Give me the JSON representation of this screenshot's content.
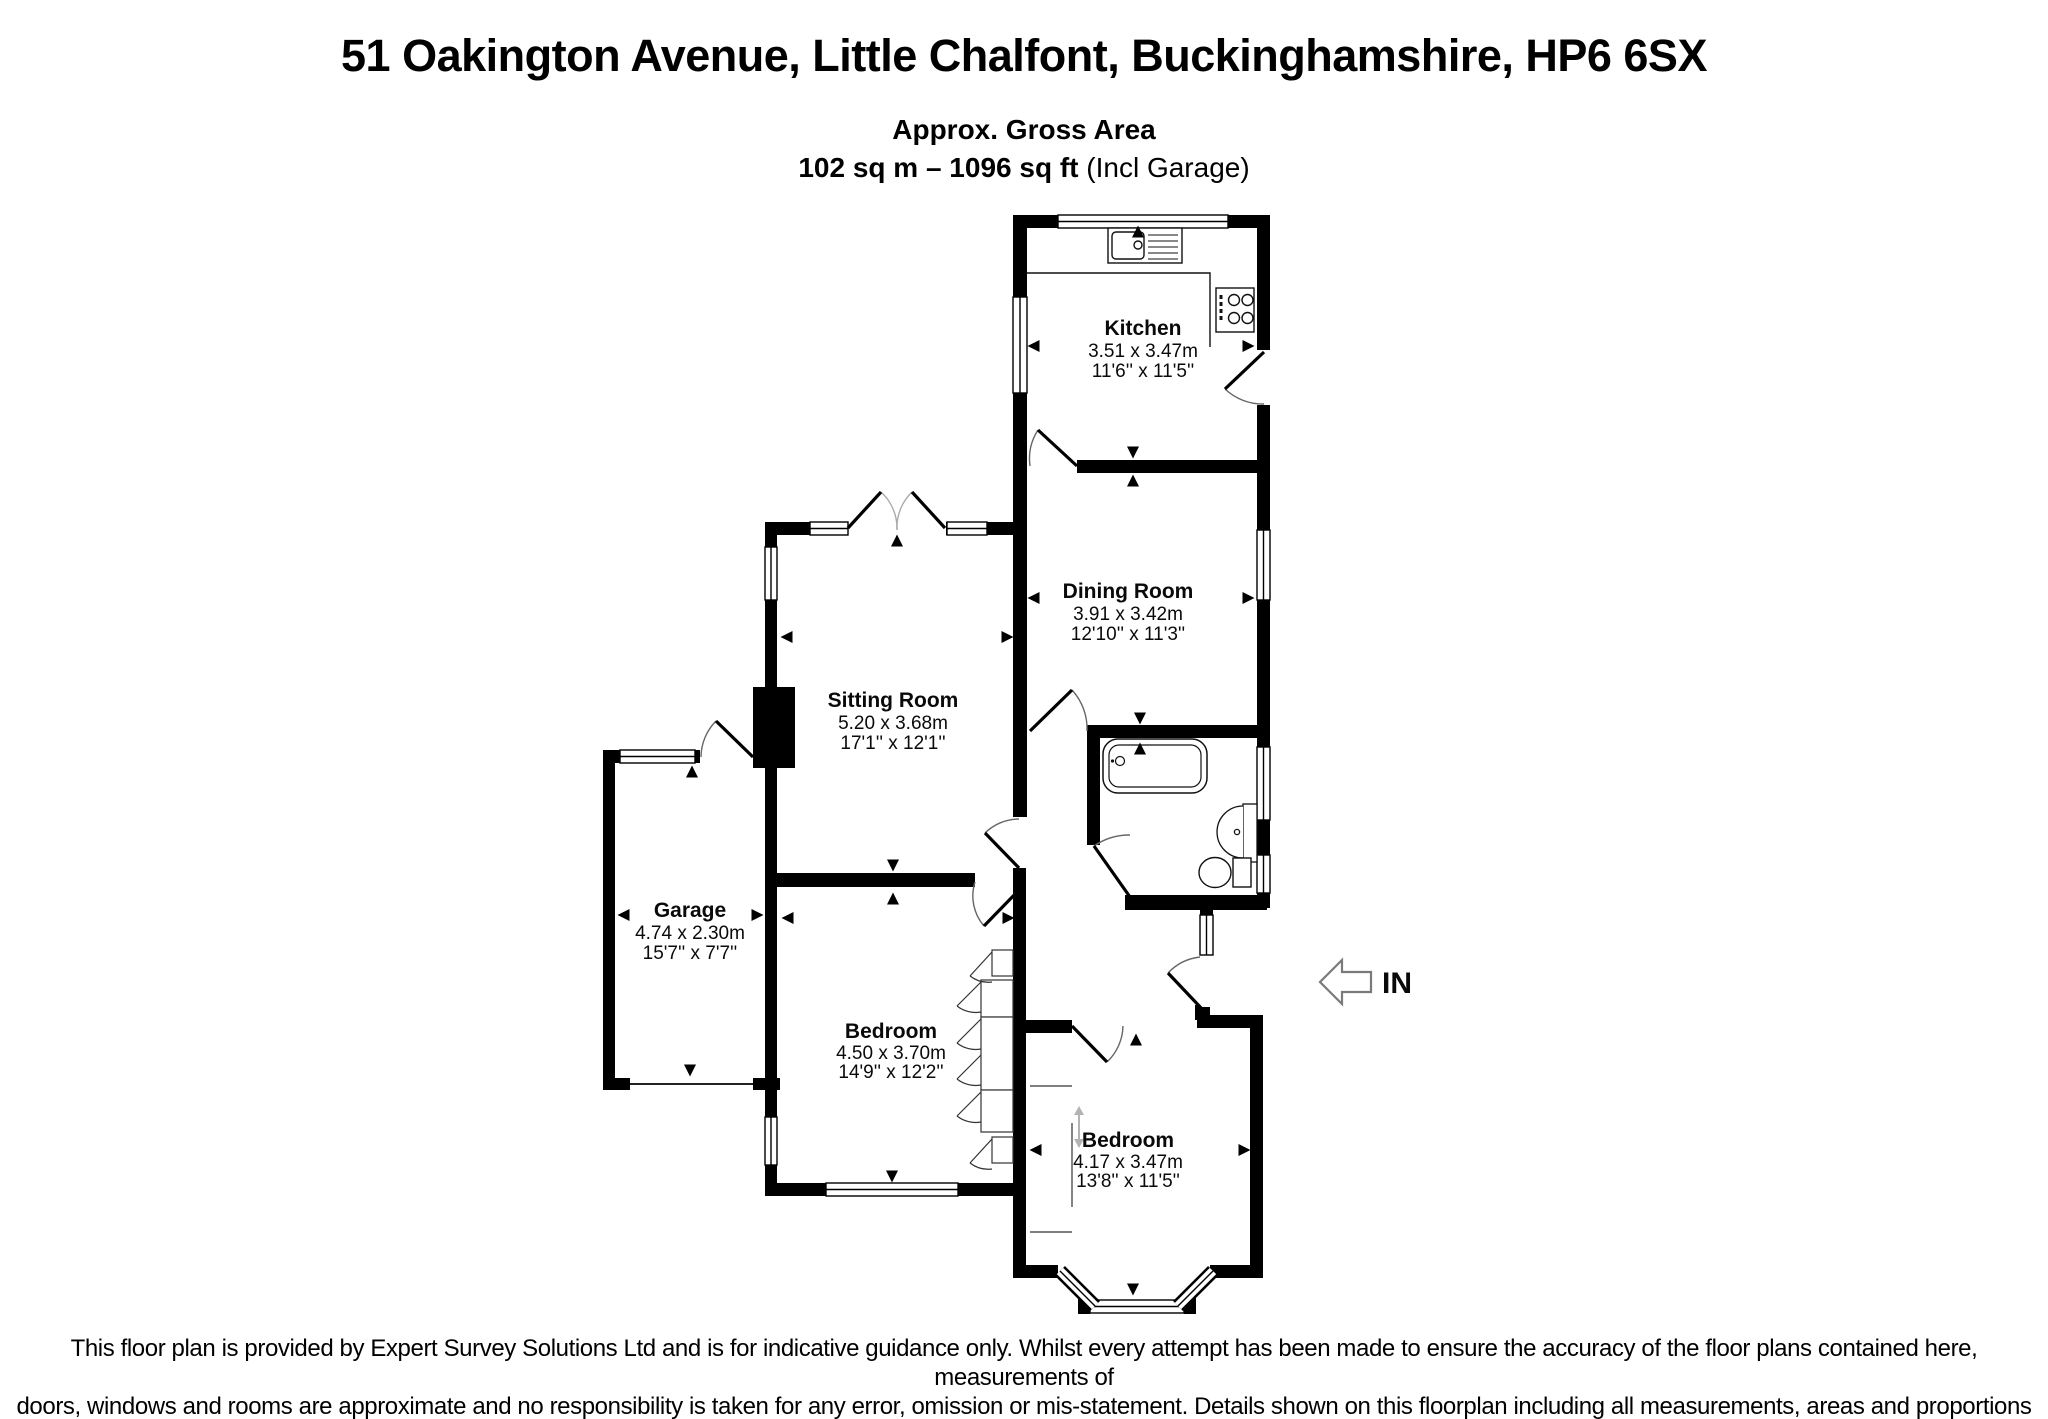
{
  "header": {
    "title": "51 Oakington Avenue, Little Chalfont, Buckinghamshire, HP6 6SX",
    "area_heading": "Approx. Gross Area",
    "area_value": "102 sq m – 1096 sq ft",
    "area_note": " (Incl Garage)"
  },
  "rooms": {
    "kitchen": {
      "name": "Kitchen",
      "metric": "3.51 x 3.47m",
      "imperial": "11'6'' x 11'5''"
    },
    "dining": {
      "name": "Dining Room",
      "metric": "3.91 x 3.42m",
      "imperial": "12'10'' x 11'3''"
    },
    "sitting": {
      "name": "Sitting Room",
      "metric": "5.20 x 3.68m",
      "imperial": "17'1'' x 12'1''"
    },
    "garage": {
      "name": "Garage",
      "metric": "4.74 x 2.30m",
      "imperial": "15'7'' x 7'7''"
    },
    "bedroom1": {
      "name": "Bedroom",
      "metric": "4.50 x 3.70m",
      "imperial": "14'9'' x 12'2''"
    },
    "bedroom2": {
      "name": "Bedroom",
      "metric": "4.17 x 3.47m",
      "imperial": "13'8'' x 11'5''"
    }
  },
  "entrance": {
    "label": "IN"
  },
  "footer": {
    "line1": "This floor plan is provided by Expert Survey Solutions Ltd and is for indicative guidance only. Whilst every attempt has been made to ensure the accuracy of the floor plans contained here, measurements of",
    "line2": "doors, windows and rooms are approximate and no responsibility is taken for any error, omission or mis-statement. Details shown on this floorplan including all measurements, areas and proportions cannot be",
    "line3": "guaranteed by either the provider or Robsons and should not be relied upon.  If there is any area where accuracy is required, please contact the selling agent for clarification."
  }
}
